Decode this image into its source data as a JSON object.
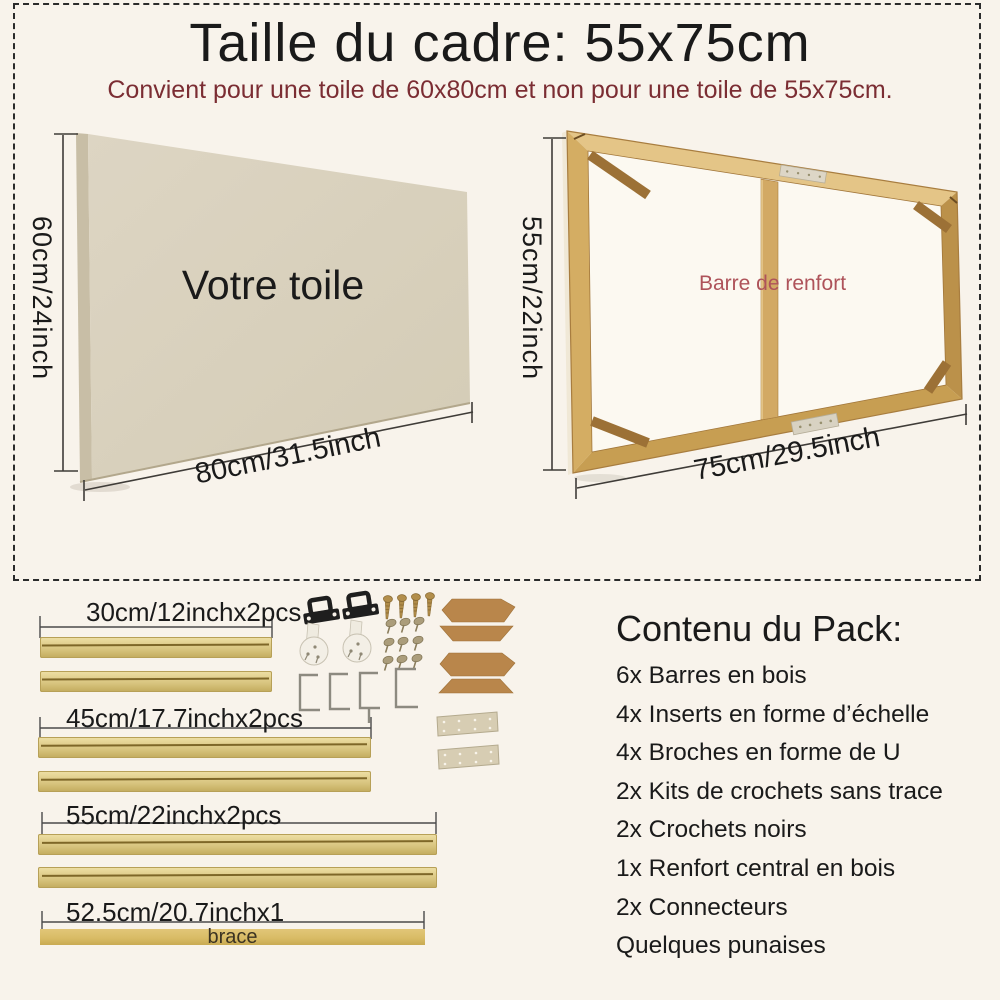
{
  "header": {
    "title": "Taille du cadre: 55x75cm",
    "subtitle": "Convient pour une toile de 60x80cm et non pour une toile de 55x75cm."
  },
  "canvas_diagram": {
    "label": "Votre toile",
    "height_label": "60cm/24inch",
    "width_label": "80cm/31.5inch"
  },
  "frame_diagram": {
    "height_label": "55cm/22inch",
    "width_label": "75cm/29.5inch",
    "brace_label": "Barre de renfort"
  },
  "parts": {
    "groups": [
      {
        "label": "30cm/12inchx2pcs"
      },
      {
        "label": "45cm/17.7inchx2pcs"
      },
      {
        "label": "55cm/22inchx2pcs"
      },
      {
        "label": "52.5cm/20.7inchx1",
        "bar_text": "brace"
      }
    ]
  },
  "pack": {
    "title": "Contenu du Pack:",
    "items": [
      "6x Barres en bois",
      "4x Inserts en forme d’échelle",
      "4x Broches en forme de U",
      "2x Kits de crochets sans trace",
      "2x Crochets noirs",
      "1x Renfort central en bois",
      "2x Connecteurs",
      "Quelques punaises"
    ]
  },
  "icons": {
    "black-hook": "black sawtooth hanger",
    "no-trace-hook": "white plastic no-trace hook",
    "screw": "brass screw",
    "pushpin": "brass thumbtack",
    "u-pin": "U-shaped pin",
    "ladder-insert": "cardboard wedge insert",
    "connector-plate": "metal plate with holes"
  },
  "colors": {
    "background": "#f8f3eb",
    "accent_maroon": "#7b2d33",
    "brace_label_red": "#ae535a",
    "wood": "#cfa95e",
    "bar_gold": "#d9c583",
    "cardboard": "#b9864b"
  }
}
